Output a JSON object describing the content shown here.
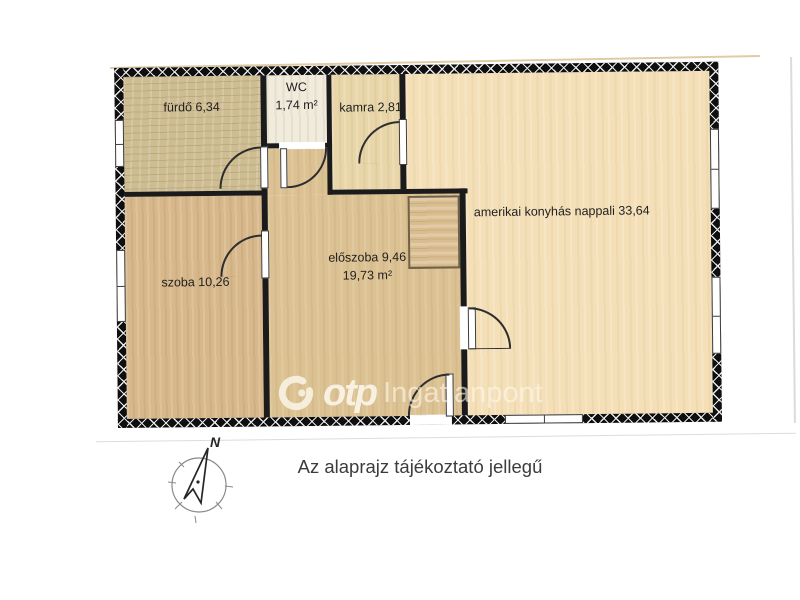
{
  "floorplan": {
    "rooms": {
      "furdo": {
        "label": "fürdő 6,34"
      },
      "wc": {
        "label": "WC",
        "area": "1,74 m²"
      },
      "kamra": {
        "label": "kamra 2,81"
      },
      "nappali": {
        "label": "amerikai konyhás nappali 33,64"
      },
      "szoba": {
        "label": "szoba 10,26"
      },
      "eloszoba": {
        "label": "előszoba 9,46",
        "area": "19,73 m²"
      }
    },
    "colors": {
      "wall": "#0f0f0f",
      "furdo": "#cfbd92",
      "szoba": "#d8b88b",
      "eloszoba": "#dcc292",
      "kamra": "#e8d6a9",
      "wc": "#f1ebdc",
      "nappali": "#f4dfb7",
      "closet": "#d9bd8e"
    }
  },
  "watermark": {
    "brand": "otp",
    "name": "Ingatlanpont"
  },
  "compass": {
    "north_label": "N"
  },
  "note": {
    "text": "Az alaprajz tájékoztató jellegű"
  }
}
